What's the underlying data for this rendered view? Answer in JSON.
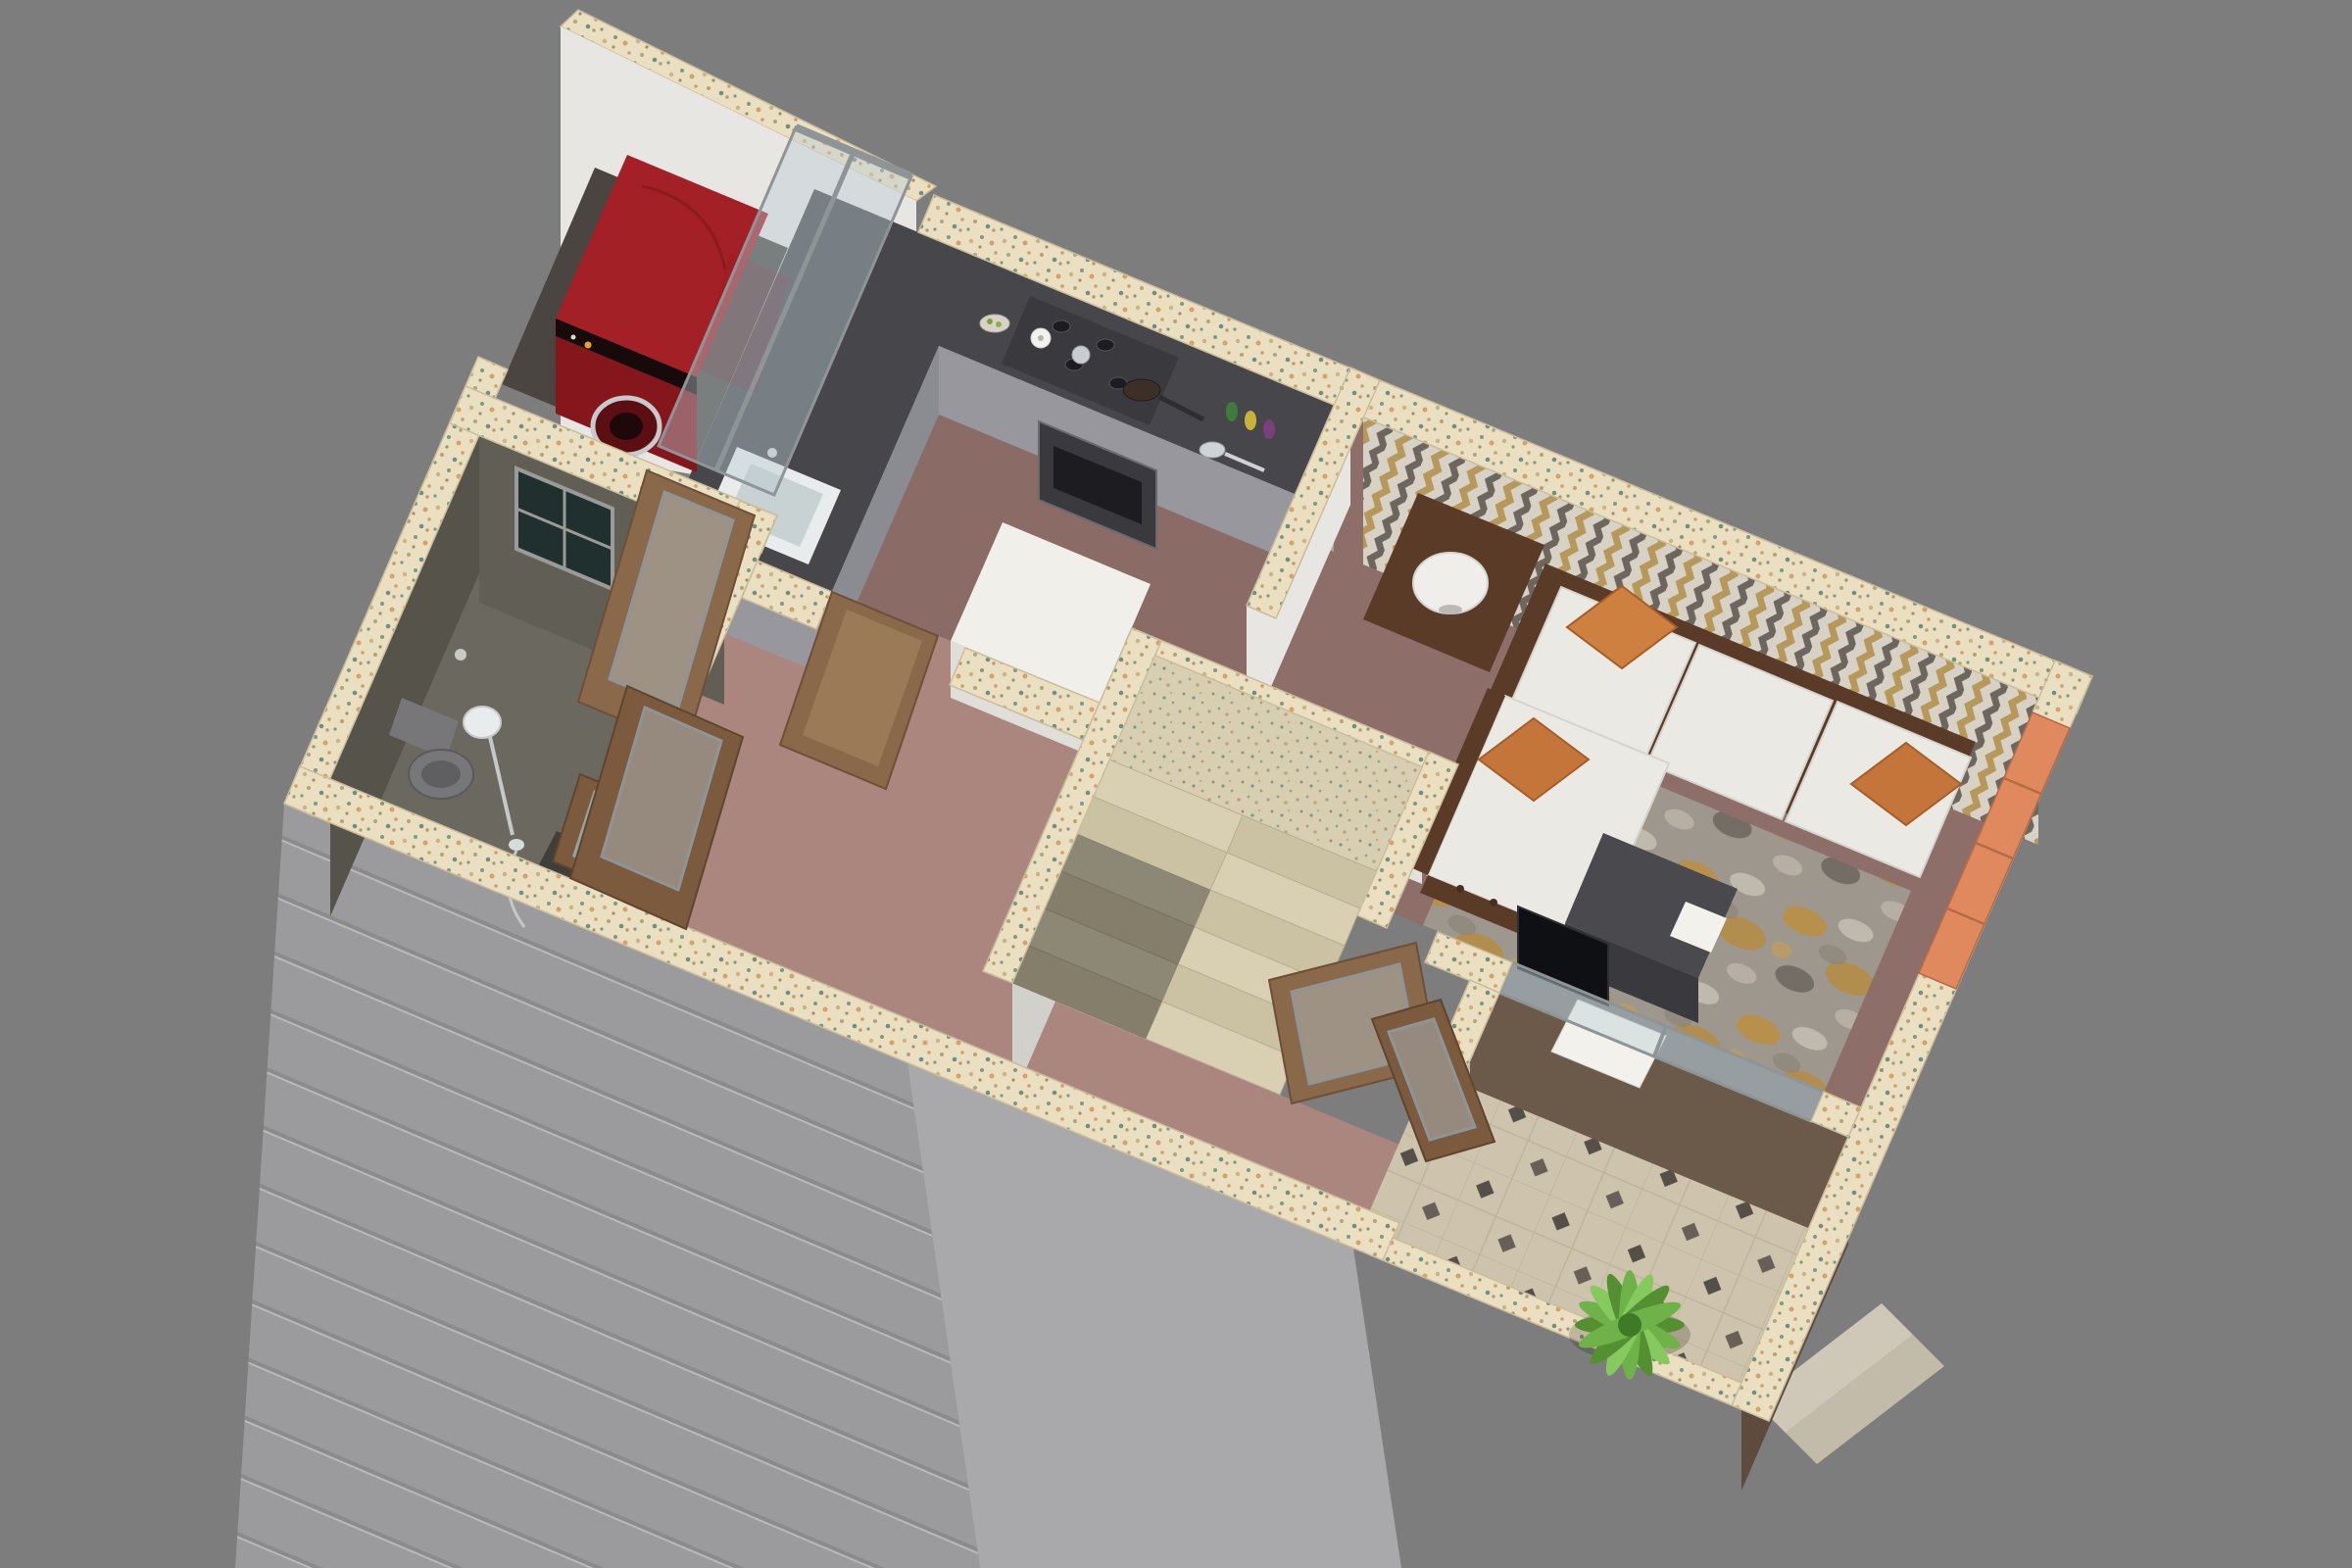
{
  "scene": {
    "type": "3d-isometric-floor-plan-render",
    "description": "Bird's-eye 3D cutaway render of a one-bedroom apartment unit on a gray background",
    "rooms": [
      {
        "name": "utility-balcony",
        "features": [
          "red front-load washing machine",
          "glass sliding partition",
          "dark tiled floor"
        ]
      },
      {
        "name": "kitchen",
        "features": [
          "L-shaped dark countertop",
          "stainless cabinets",
          "oven and cooktop",
          "sink",
          "white refrigerator",
          "tan stone tile backsplash",
          "cookware and bottles on counter"
        ]
      },
      {
        "name": "bathroom",
        "features": [
          "dark textured walls",
          "window",
          "gray toilet",
          "shower set",
          "basin with mirror",
          "toilet paper holder"
        ]
      },
      {
        "name": "staircase",
        "features": [
          "U-shaped switchback stair",
          "speckled granite treads",
          "upper landing",
          "white stairwell walls"
        ]
      },
      {
        "name": "hallway-foyer",
        "features": [
          "mauve tile floor",
          "open wooden doors"
        ]
      },
      {
        "name": "living-room",
        "features": [
          "chevron accent wallpaper",
          "wood-frame sofa with white cushions",
          "orange throw pillows",
          "cylindrical table lamp",
          "gray-gold area rug",
          "dark coffee table",
          "TV on media divider"
        ]
      },
      {
        "name": "balcony",
        "features": [
          "beige tiles with dark diamond accents",
          "green potted palm plant",
          "glass balustrade window",
          "exterior steps"
        ]
      }
    ],
    "objects": [
      "washing-machine",
      "glass-partition",
      "kitchen-counter",
      "cooktop",
      "oven",
      "kitchen-sink",
      "refrigerator",
      "mixing-bowl",
      "paper-towel-roll",
      "canister",
      "frying-pan",
      "saucepan",
      "spice-bottles",
      "toilet",
      "shower-head",
      "shower-handset",
      "vanity-basin",
      "mirror",
      "bathroom-window",
      "stair-landing",
      "stair-steps",
      "sofa",
      "chaise",
      "seat-cushions",
      "throw-pillows",
      "table-lamp",
      "side-table",
      "area-rug",
      "coffee-table",
      "magazine",
      "television",
      "tv-console-glass",
      "entry-doors",
      "kitchen-door",
      "bathroom-doors",
      "potted-plant",
      "brick-wall-edge",
      "exterior-steps"
    ],
    "wall_finishes": {
      "wall_tops": "cream speckled granite",
      "exterior_southwest": "light gray with horizontal grooves",
      "living_accent": "gold and gray chevron zigzag wallpaper",
      "kitchen_backsplash": "tan travertine tiles",
      "bathroom": "dark olive textured stone"
    }
  },
  "palette": {
    "bg": "#7d7d7d",
    "speckle_base": "#ebdfc1",
    "granite_base": "#d8cfb2",
    "tread_a": "#d9d0b4",
    "tread_b": "#cbc2a4",
    "wall_white": "#e8e6e3",
    "wall_white_shade": "#d8d6d1",
    "stair_face": "#e3e1dc",
    "stair_face_side": "#d2d0ca",
    "gray_wall": "#9b9b9d",
    "gray_wall_light": "#a9a9ab",
    "stripe_line": "#8b8b8d",
    "backsplash": "#b3a089",
    "backsplash_line": "#9f8d77",
    "chevron_bg": "#d8d2c6",
    "chevron_gold": "#b5985a",
    "chevron_gray": "#6d665f",
    "floor_utility": "#4b4542",
    "floor_kitchen": "#8a6b66",
    "floor_hall": "#aa867f",
    "floor_living": "#8d6e69",
    "floor_bathroom": "#6b695f",
    "bath_wall": "#615f55",
    "bath_wall_dark": "#55534a",
    "window_glass": "#20302e",
    "window_frame": "#9a9a98",
    "counter_top": "#47474b",
    "counter_face": "#97979d",
    "counter_face_dark": "#8b8b92",
    "appliance_dark": "#3a3a3e",
    "appliance_inner": "#1d1d21",
    "porcelain": "#e9ecec",
    "porcelain_shade": "#c9d2d2",
    "fridge_top": "#f1efe9",
    "fridge_face": "#e0ded8",
    "washer_red": "#a32026",
    "washer_red_dark": "#85161c",
    "washer_panel": "#170a0a",
    "drum_dark": "#5c0f13",
    "chrome": "#c4c8c9",
    "toilet_gray": "#77777a",
    "toilet_gray_dark": "#5f5f62",
    "sofa_wood": "#5a3b28",
    "sofa_wood_dark": "#46301f",
    "cushion": "#ebe9e4",
    "cushion_line": "#d6d3cc",
    "pillow_a": "#c4763a",
    "pillow_b": "#cd8040",
    "rug_base": "#9e978d",
    "rug_gold": "#bd8f3b",
    "rug_cream": "#cfc8bb",
    "rug_dark": "#57524c",
    "table_dark": "#4a4a4e",
    "table_dark_face": "#3a3a3e",
    "paper_white": "#f2f1ec",
    "balcony_tile": "#cec4ad",
    "tile_diamond": "#564f47",
    "tile_line": "#bdb49c",
    "brick": "#e0895e",
    "brick_line": "#b56a44",
    "brown_wall": "#6b5a4a",
    "brown_wall_dark": "#5e4b3e",
    "glass_tint": "rgba(185,205,212,0.42)",
    "glass_frame": "#8f9496",
    "wood_door": "#8a684a",
    "wood_door_dark": "#7b5a3e",
    "wood_door_light": "#9b7a58",
    "mirror_glass": "#96a4a0",
    "plant_a": "#549032",
    "plant_b": "#6fb24a",
    "plant_c": "#86c95e",
    "plant_center": "#3e7a27",
    "pot": "#4a3a30",
    "lamp": "#efeeea",
    "tv": "#0e1013",
    "steps_ext_a": "#cfc8b8",
    "steps_ext_b": "#c2bba9"
  }
}
